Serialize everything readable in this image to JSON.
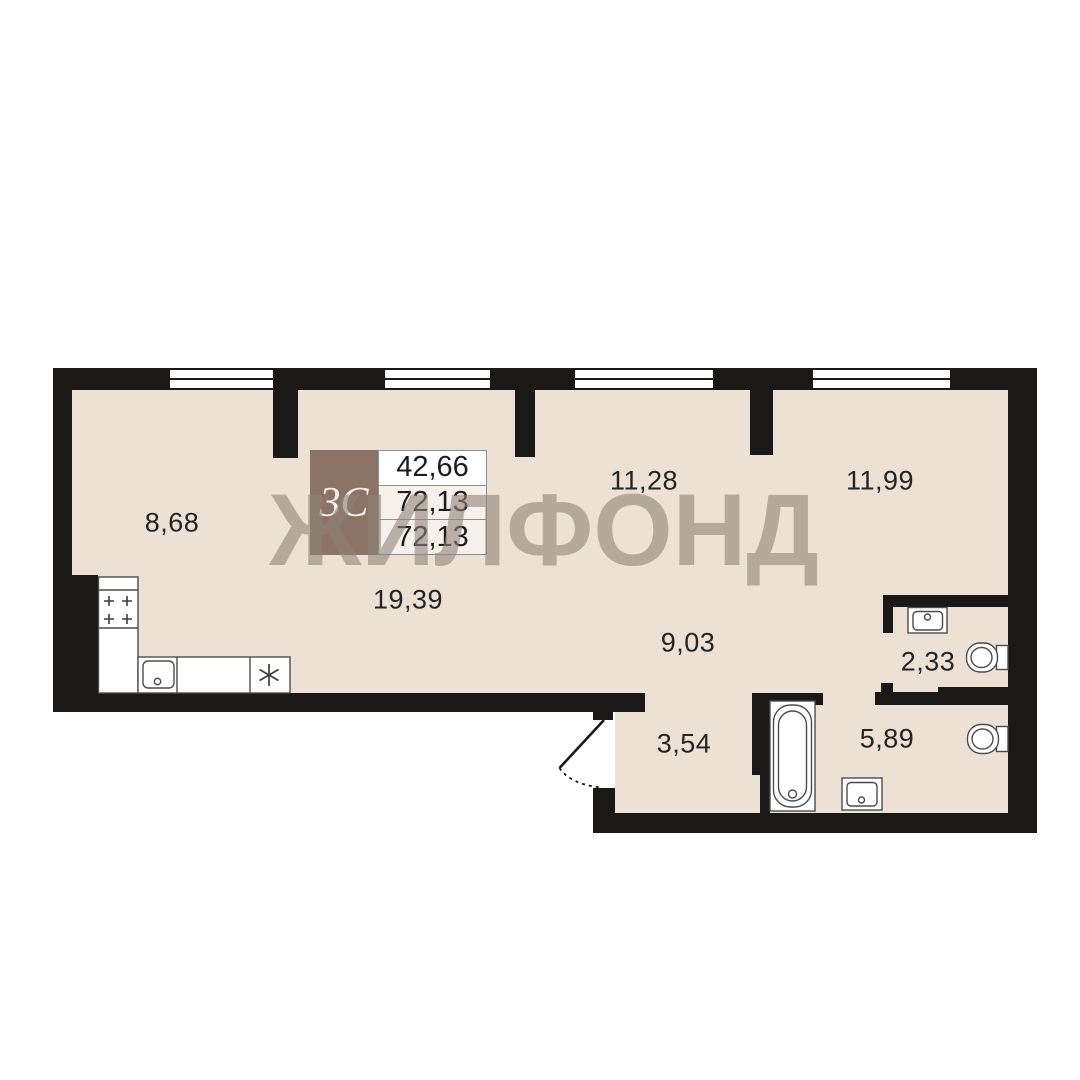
{
  "plan": {
    "watermark": "ЖИЛФОНД",
    "unit_type": "3С",
    "info_table": {
      "rows": [
        "42,66",
        "72,13",
        "72,13"
      ]
    },
    "rooms": [
      {
        "id": "room-1",
        "area": "8,68"
      },
      {
        "id": "room-2",
        "area": "19,39"
      },
      {
        "id": "room-3",
        "area": "11,28"
      },
      {
        "id": "room-4",
        "area": "11,99"
      },
      {
        "id": "room-5",
        "area": "9,03"
      },
      {
        "id": "room-6",
        "area": "2,33"
      },
      {
        "id": "room-7",
        "area": "3,54"
      },
      {
        "id": "room-8",
        "area": "5,89"
      }
    ],
    "fixtures": [
      "stove",
      "kitchen-sink",
      "refrigerator",
      "bathtub",
      "washing-machine",
      "toilet",
      "toilet",
      "washbasin",
      "entrance-door"
    ],
    "colors": {
      "wall": "#1B1917",
      "floor": "#EDE0D4",
      "info_box_brown": "#8B7365",
      "watermark": "#8F837A",
      "label_text": "#242424"
    }
  }
}
